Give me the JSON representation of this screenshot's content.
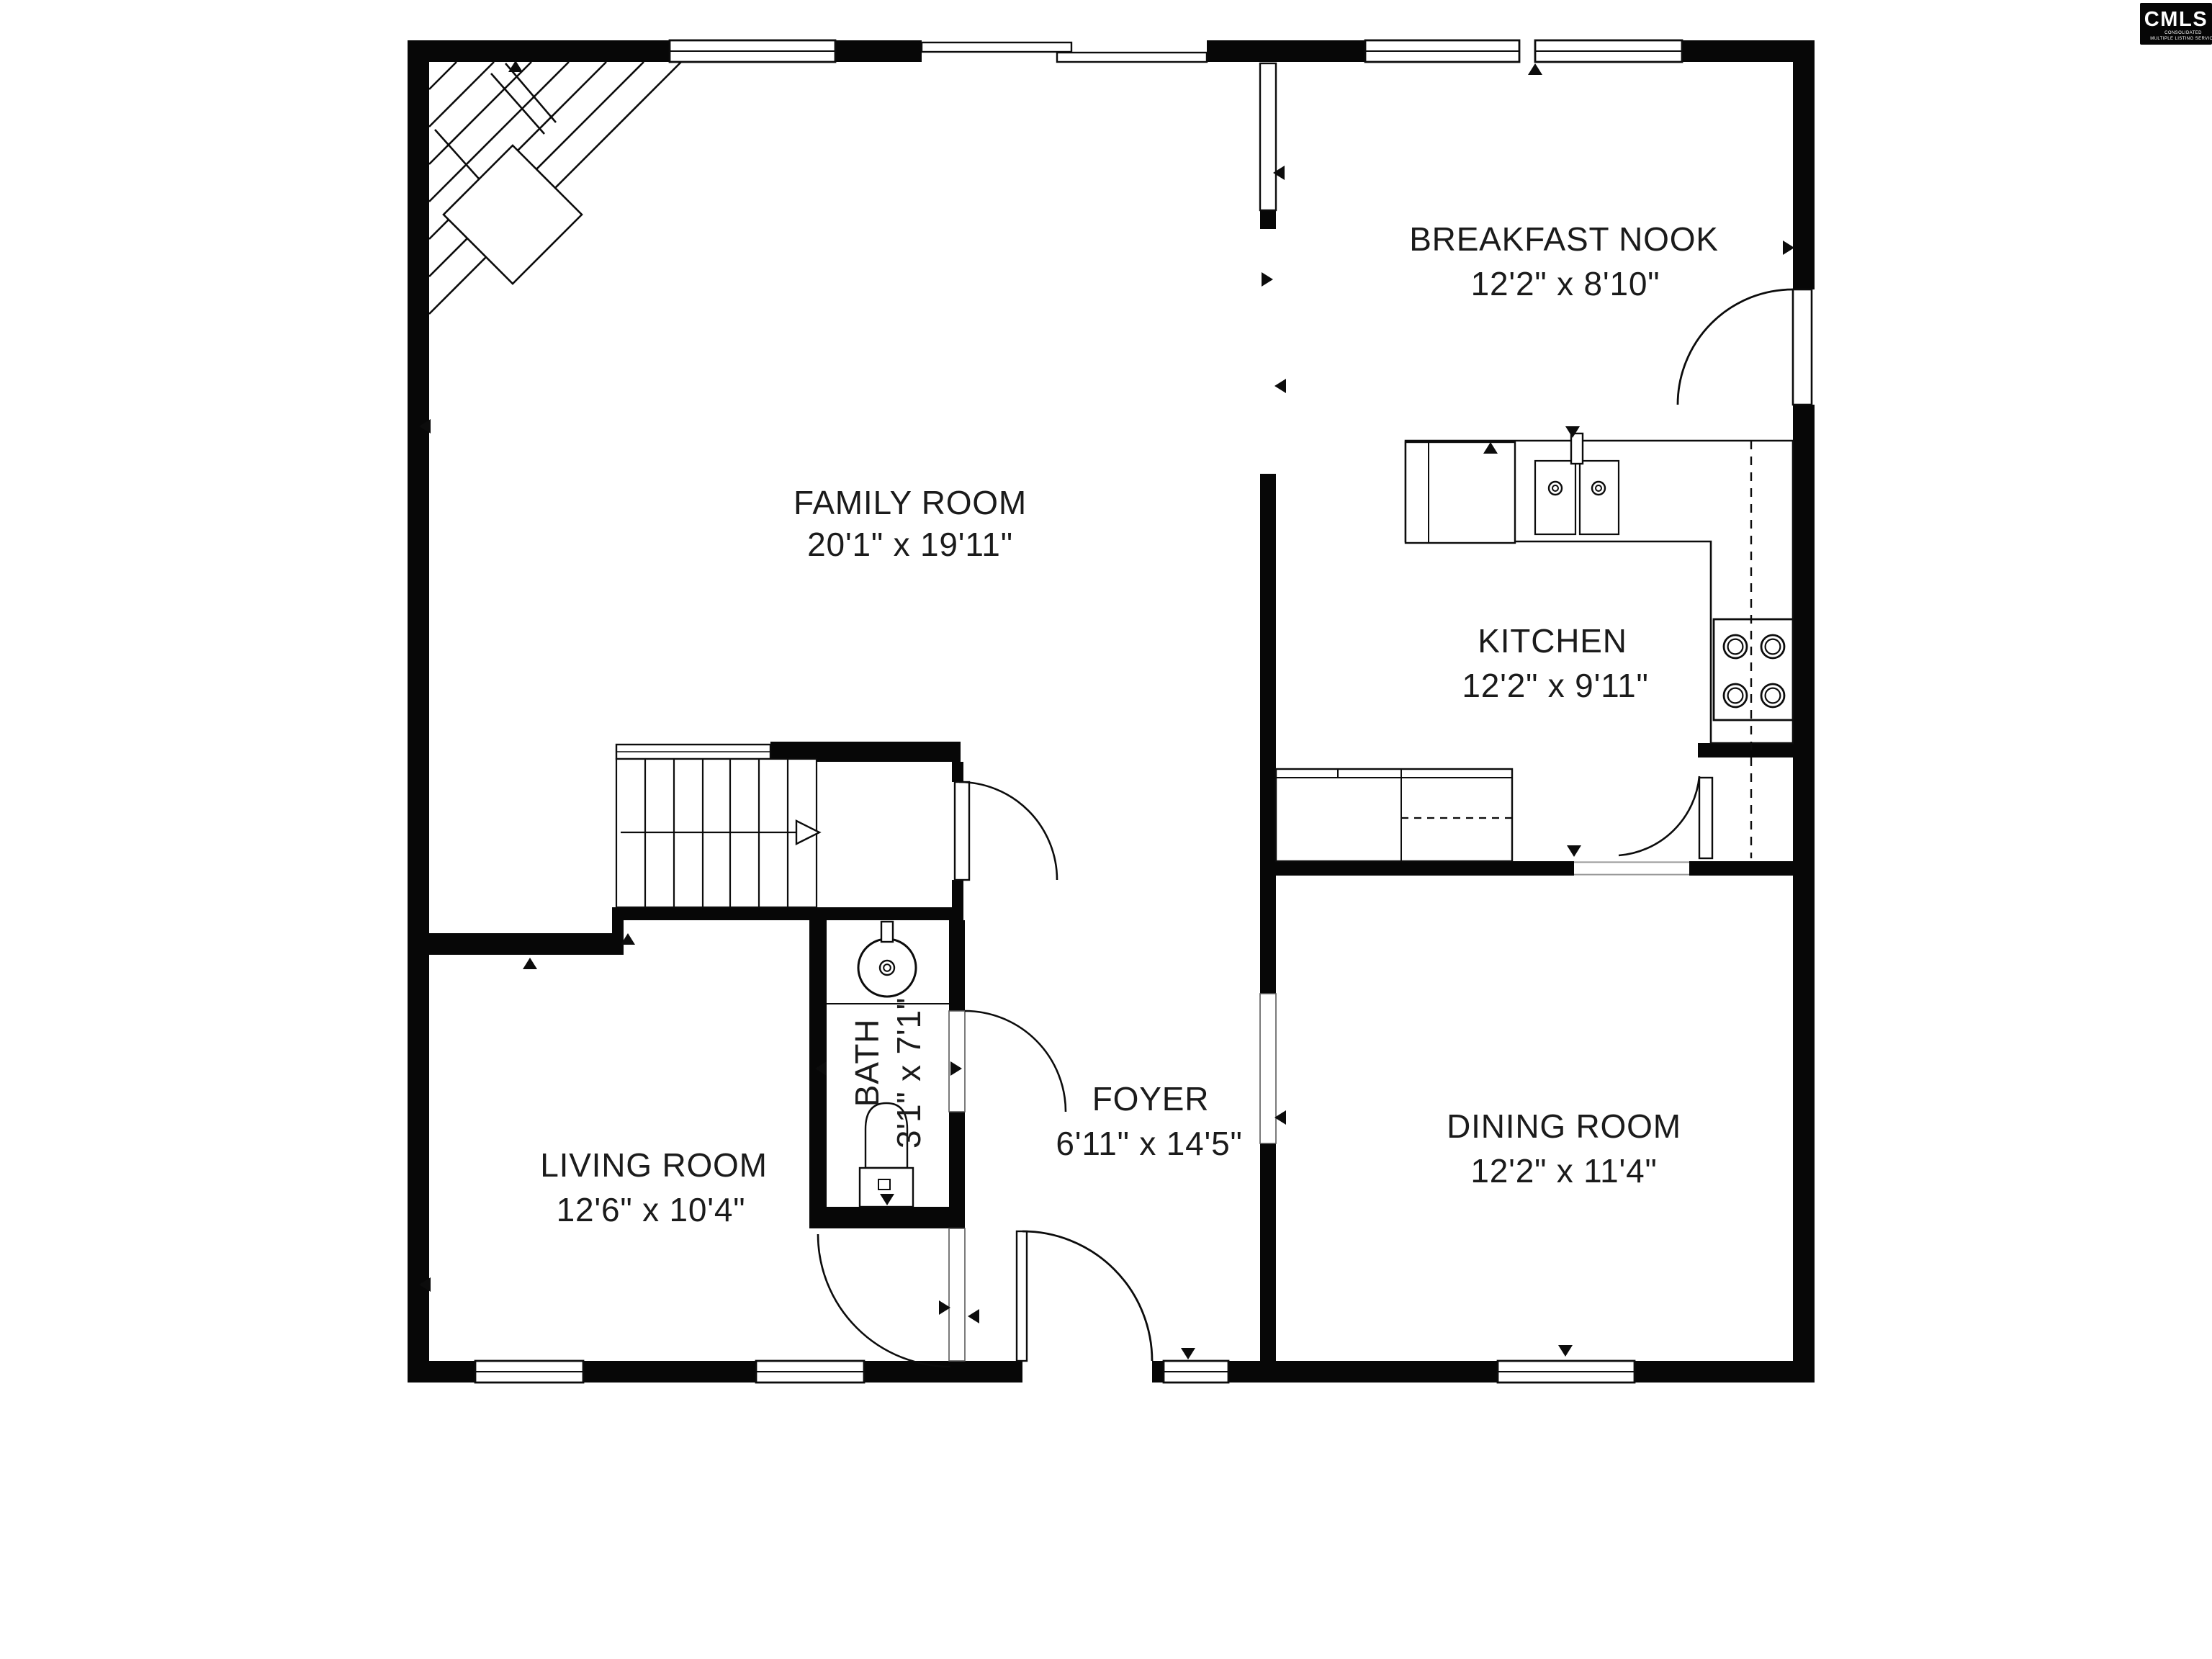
{
  "logo": {
    "name": "CMLS",
    "subtitle_line1": "CONSOLIDATED",
    "subtitle_line2": "MULTIPLE LISTING SERVICE"
  },
  "rooms": {
    "family": {
      "label": "FAMILY ROOM",
      "dims": "20'1\" x 19'11\""
    },
    "breakfast": {
      "label": "BREAKFAST NOOK",
      "dims": "12'2\" x 8'10\""
    },
    "kitchen": {
      "label": "KITCHEN",
      "dims": "12'2\" x 9'11\""
    },
    "living": {
      "label": "LIVING ROOM",
      "dims": "12'6\" x 10'4\""
    },
    "foyer": {
      "label": "FOYER",
      "dims": "6'11\" x 14'5\""
    },
    "dining": {
      "label": "DINING ROOM",
      "dims": "12'2\" x 11'4\""
    },
    "bath": {
      "label": "BATH",
      "dims": "3'1\" x 7'1\""
    }
  }
}
